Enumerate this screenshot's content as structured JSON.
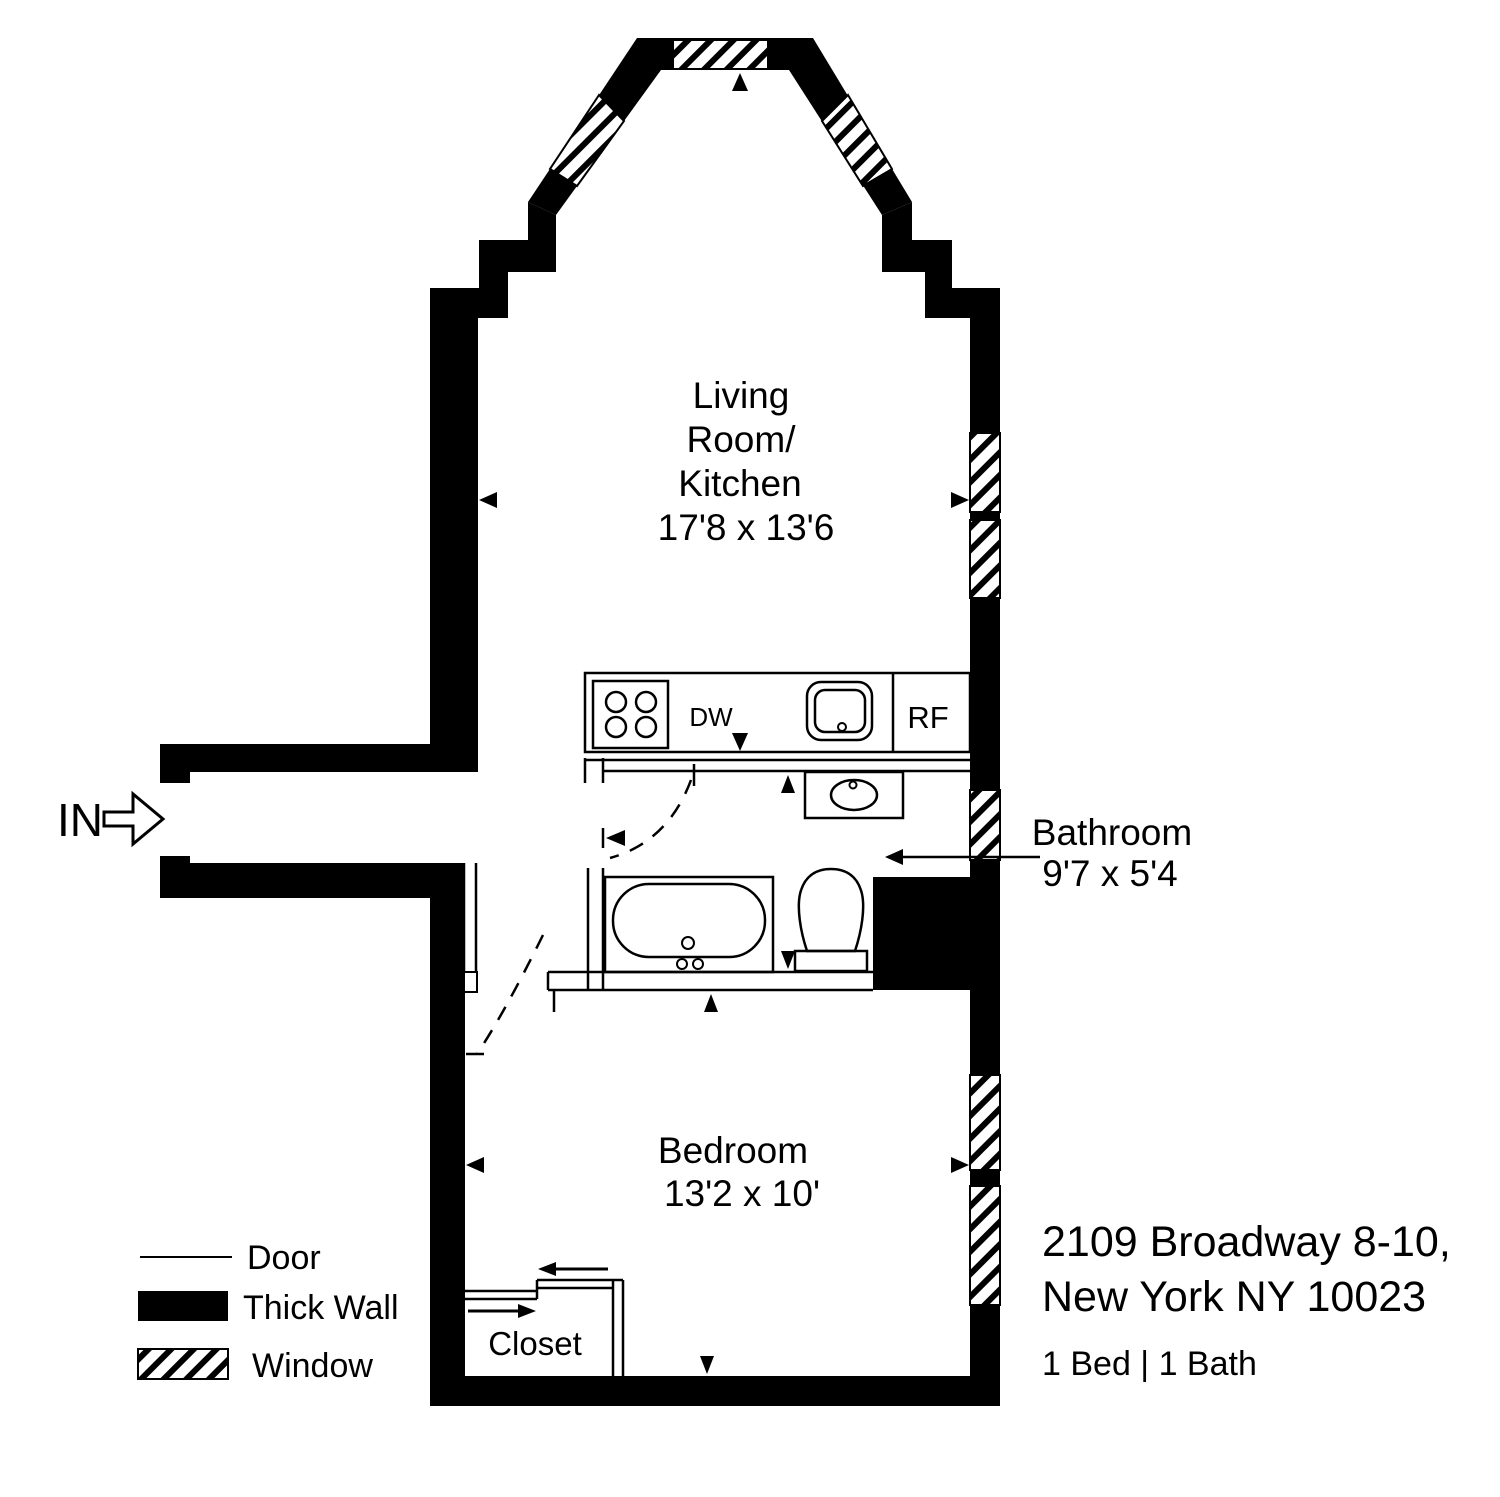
{
  "entrance": {
    "label": "IN"
  },
  "rooms": {
    "living_kitchen": {
      "line1": "Living",
      "line2": "Room/",
      "line3": "Kitchen",
      "dims": "17'8 x 13'6"
    },
    "bathroom": {
      "name": "Bathroom",
      "dims": "9'7 x 5'4"
    },
    "bedroom": {
      "name": "Bedroom",
      "dims": "13'2 x 10'"
    },
    "closet": {
      "name": "Closet"
    }
  },
  "appliances": {
    "dishwasher": "DW",
    "refrigerator": "RF"
  },
  "legend": {
    "door": "Door",
    "thick_wall": "Thick Wall",
    "window": "Window"
  },
  "listing": {
    "address_line1": "2109 Broadway 8-10,",
    "address_line2": "New York NY 10023",
    "beds_baths": "1 Bed | 1 Bath"
  },
  "colors": {
    "wall": "#000000",
    "background": "#ffffff",
    "text": "#000000"
  }
}
